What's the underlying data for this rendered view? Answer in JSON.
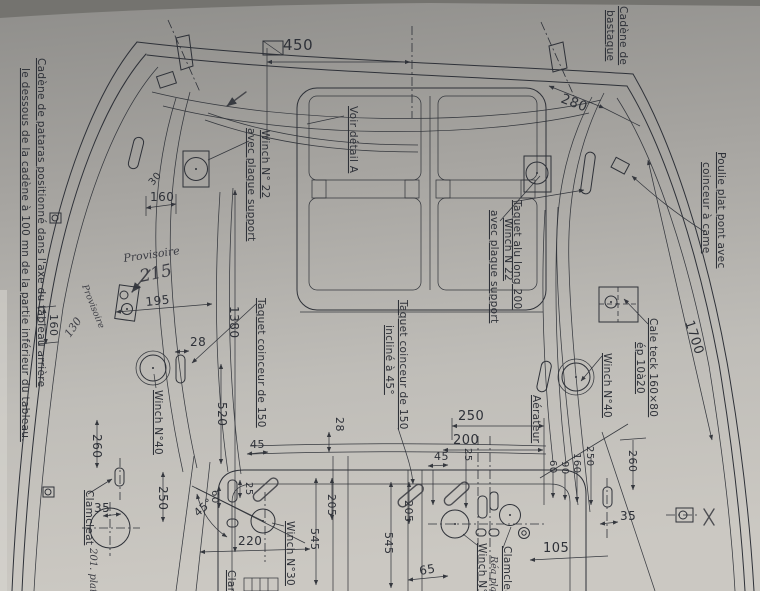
{
  "drawing": {
    "margin_note": {
      "line1": "Cadène de pataras positionné dans l'axe du tableau arrière",
      "line2": "le dessous de la cadène à 100 mn de la partie inférieur du tableau."
    },
    "labels": {
      "bastaque_1": "Cadène de",
      "bastaque_2": "bastaque",
      "poulie_1": "Poulie plat pont avec",
      "poulie_2": "coinceur à came",
      "cale_1": "Cale teck 160×80",
      "cale_2": "ép 10à20",
      "voir_detail": "Voir détail A",
      "winch22_left_1": "Winch N° 22",
      "winch22_left_2": "avec plaque support",
      "winch22_right_1": "Winch N 22",
      "winch22_right_2": "avec plaque support",
      "taquet_alu": "Taquet alu long 200",
      "taquet_coinceur_left": "Taquet coinceur de 150",
      "taquet_coinceur_center_1": "Taquet coinceur de 150",
      "taquet_coinceur_center_2": "incliné à 45°",
      "winch40_left": "Winch N°40",
      "winch40_right": "Winch N°40",
      "winch30": "Winch N°30",
      "winch_bottom_right": "Winch N°",
      "aerateur": "Aérateur",
      "clamcleat_left": "Clamcleat",
      "clamcleat_bottom_left": "Clam",
      "clamcleat_bottom_right": "Clamcleat"
    },
    "handwritten": {
      "provisoire": "Provisoire",
      "value_215": "215",
      "provisoire_diag": "Provisoire",
      "value_130": "130",
      "clamcleat_suffix": "201. plat",
      "rea_note": "Réa plat"
    },
    "dimensions": {
      "d450": "450",
      "d280": "280",
      "d1700": "1700",
      "d160_top": "160",
      "d30": "30",
      "d195": "195",
      "d160_left": "160",
      "d28_left": "28",
      "d1380": "1380",
      "d520": "520",
      "d260_left": "260",
      "d250_left": "250",
      "d35_left": "35",
      "d28_center": "28",
      "d45_small": "45",
      "d25_small_left": "25",
      "d60_small": "60",
      "d45deg": "45°",
      "d220": "220",
      "d205_a": "205",
      "d545_a": "545",
      "d205_b": "205",
      "d545_b": "545",
      "d250_c": "250",
      "d200_c": "200",
      "d45_c": "45",
      "d25_c": "25",
      "d60_r": "60",
      "d90_r": "90",
      "d160_r": "160",
      "d250_r": "250",
      "d260_right": "260",
      "d35_right": "35",
      "d105": "105",
      "d65": "65"
    }
  }
}
